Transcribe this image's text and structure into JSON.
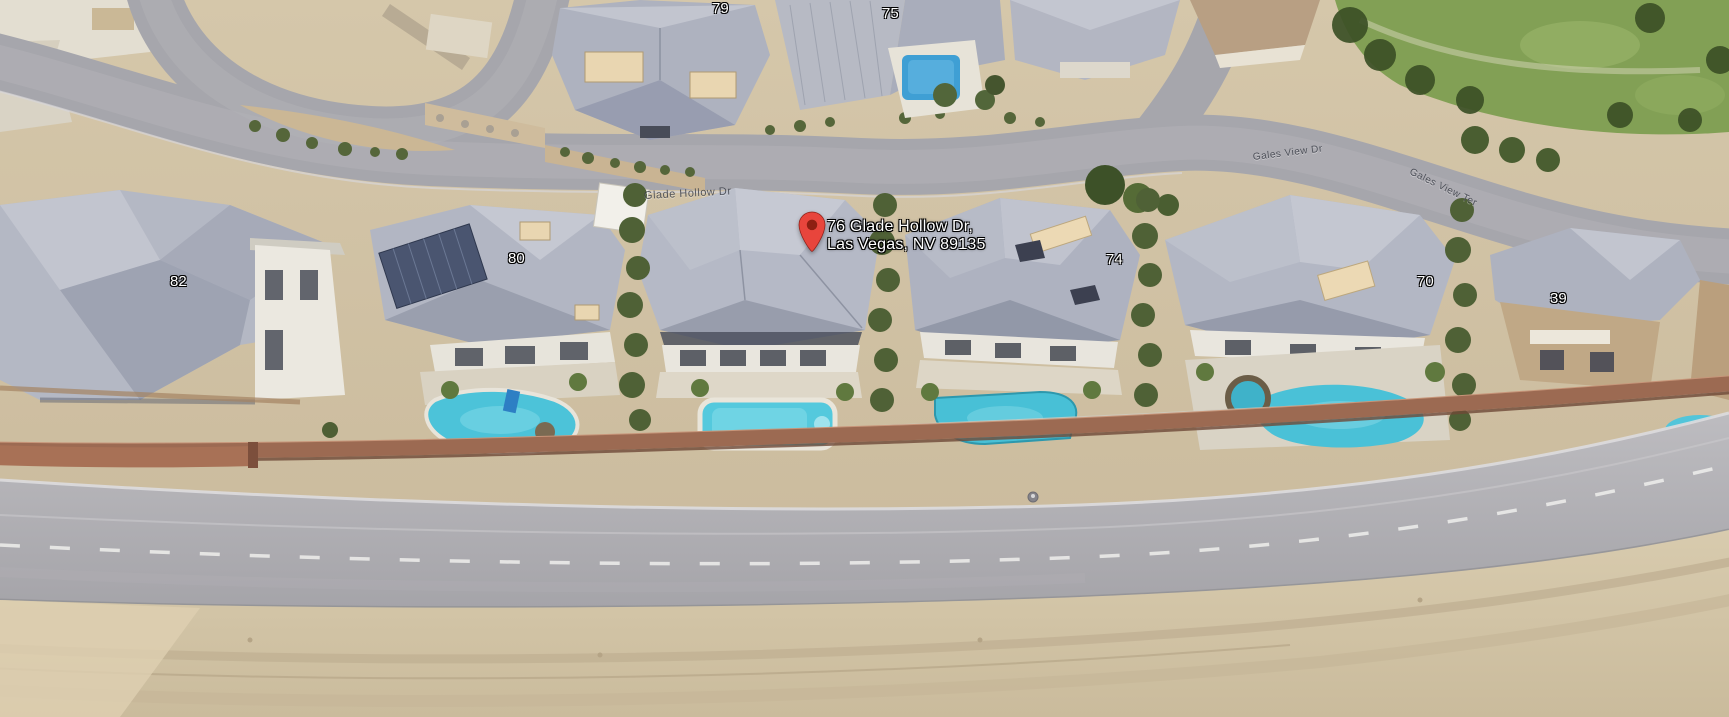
{
  "view": {
    "type": "aerial-3d-satellite",
    "city": "Las Vegas"
  },
  "map": {
    "pin": {
      "line1": "76 Glade Hollow Dr,",
      "line2": "Las Vegas, NV 89135",
      "color": "#E8453C",
      "dot_color": "#8E1F12"
    },
    "street_labels": [
      {
        "text": "Glade Hollow Dr"
      },
      {
        "text": "Gales View Dr"
      },
      {
        "text": "Gales View Ter"
      }
    ],
    "house_numbers": [
      {
        "text": "79"
      },
      {
        "text": "75"
      },
      {
        "text": "82"
      },
      {
        "text": "80"
      },
      {
        "text": "74"
      },
      {
        "text": "70"
      },
      {
        "text": "39"
      }
    ]
  },
  "colors": {
    "desert_tan": "#CFC0A4",
    "road_gray": "#A6A6AC",
    "highway_gray": "#B4B3B7",
    "roof_gray": "#AEB2BF",
    "pool_cyan": "#4FC4DA",
    "wall_brown": "#9C6A52",
    "grass_green": "#82A055",
    "tree_olive": "#4F6136"
  }
}
